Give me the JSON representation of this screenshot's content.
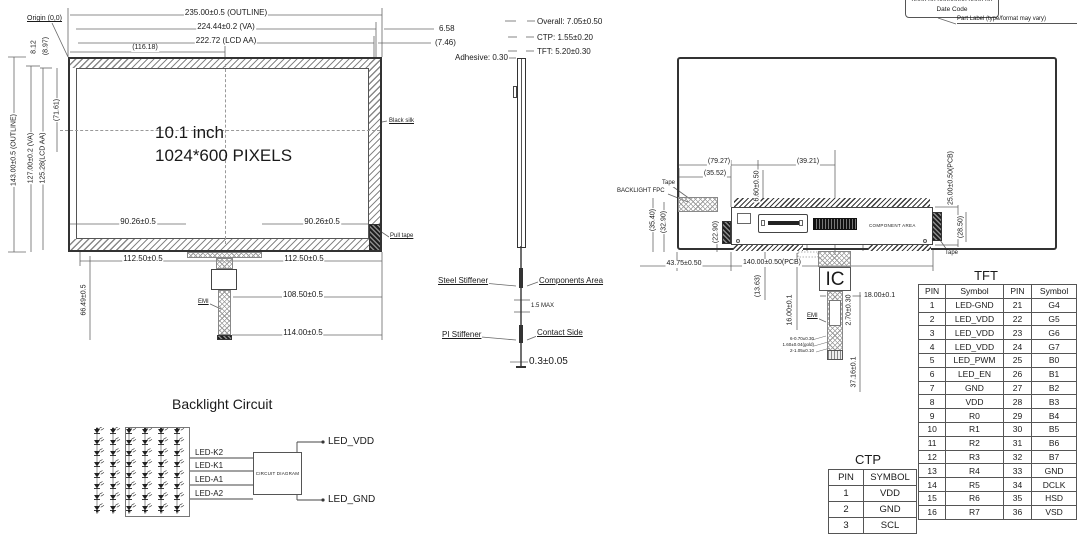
{
  "front_view": {
    "center_line1": "10.1 inch",
    "center_line2": "1024*600 PIXELS",
    "origin_label": "Origin (0,0)",
    "dim_outline_w": "235.00±0.5 (OUTLINE)",
    "dim_va_w": "224.44±0.2 (VA)",
    "dim_aa_w": "222.72 (LCD AA)",
    "dim_center_x": "(116.18)",
    "dim_right_gap": "6.58",
    "dim_right_gap2": "(7.46)",
    "dim_outline_h": "143.00±0.5 (OUTLINE)",
    "dim_va_h": "127.00±0.2 (VA)",
    "dim_aa_h": "125.28(LCD AA)",
    "dim_center_y": "(71.61)",
    "dim_top_gap": "8.12",
    "dim_top_gap2": "(8.97)",
    "black_silk_label": "Black silk",
    "pull_tape_label": "Pull tape",
    "dim_screw_left": "90.26±0.5",
    "dim_screw_right": "90.26±0.5",
    "dim_bottom_left": "112.50±0.5",
    "dim_bottom_right": "112.50±0.5",
    "dim_fpc_108": "108.50±0.5",
    "dim_fpc_114": "114.00±0.5",
    "dim_tail_v": "66.49±0.5",
    "emi_label": "EMI"
  },
  "side_view": {
    "overall": "Overall: 7.05±0.50",
    "ctp": "CTP: 1.55±0.20",
    "tft": "TFT: 5.20±0.30",
    "adhesive": "Adhesive: 0.30",
    "steel_stiffener": "Steel Stiffener",
    "components_area": "Components Area",
    "max_label": "1.5 MAX",
    "pi_stiffener": "PI Stiffener",
    "contact_side": "Contact Side",
    "bottom_dim": "0.3±0.05"
  },
  "back_view": {
    "part_no_clipped": "XXXX-XX-XXXXXXXX-XXXX-XX",
    "date_code": "Date Code",
    "part_label_note": "Part Label (type/format may vary)",
    "tape_left": "Tape",
    "backlight_fpc": "BACKLIGHT FPC",
    "component_area": "COMPONENT AREA",
    "tape_right": "Tape",
    "ic_label": "IC",
    "emi_label": "EMI",
    "dims": {
      "d7927": "(79.27)",
      "d3552": "(35.52)",
      "d3921": "(39.21)",
      "d660": "6.60±0.50",
      "d25pcb": "25.00±0.50(PCB)",
      "d3540": "(35.40)",
      "d3290": "(32.90)",
      "d2290": "(22.90)",
      "d2850": "(28.50)",
      "d4375": "43.75±0.50",
      "d140pcb": "140.00±0.50(PCB)",
      "d1363": "(13.63)",
      "d16": "16.00±0.1",
      "d18": "18.00±0.1",
      "d270": "2.70±0.30",
      "d3716": "37.16±0.1",
      "fpc_note1": "6-0.70±0.30",
      "fpc_note2": "1.60±0.04(gold)",
      "fpc_note3": "2-1.05±0.10"
    }
  },
  "backlight_circuit": {
    "title": "Backlight Circuit",
    "wire_labels": [
      "LED-K2",
      "LED-K1",
      "LED-A1",
      "LED-A2"
    ],
    "box_label": "CIRCUIT DIAGRAM",
    "out_top": "LED_VDD",
    "out_bottom": "LED_GND"
  },
  "ctp_table": {
    "title": "CTP",
    "headers": [
      "PIN",
      "SYMBOL"
    ],
    "rows": [
      [
        "1",
        "VDD"
      ],
      [
        "2",
        "GND"
      ],
      [
        "3",
        "SCL"
      ]
    ]
  },
  "tft_table": {
    "title": "TFT",
    "headers": [
      "PIN",
      "Symbol",
      "PIN",
      "Symbol"
    ],
    "rows": [
      [
        "1",
        "LED-GND",
        "21",
        "G4"
      ],
      [
        "2",
        "LED_VDD",
        "22",
        "G5"
      ],
      [
        "3",
        "LED_VDD",
        "23",
        "G6"
      ],
      [
        "4",
        "LED_VDD",
        "24",
        "G7"
      ],
      [
        "5",
        "LED_PWM",
        "25",
        "B0"
      ],
      [
        "6",
        "LED_EN",
        "26",
        "B1"
      ],
      [
        "7",
        "GND",
        "27",
        "B2"
      ],
      [
        "8",
        "VDD",
        "28",
        "B3"
      ],
      [
        "9",
        "R0",
        "29",
        "B4"
      ],
      [
        "10",
        "R1",
        "30",
        "B5"
      ],
      [
        "11",
        "R2",
        "31",
        "B6"
      ],
      [
        "12",
        "R3",
        "32",
        "B7"
      ],
      [
        "13",
        "R4",
        "33",
        "GND"
      ],
      [
        "14",
        "R5",
        "34",
        "DCLK"
      ],
      [
        "15",
        "R6",
        "35",
        "HSD"
      ],
      [
        "16",
        "R7",
        "36",
        "VSD"
      ]
    ]
  },
  "colors": {
    "line": "#555555",
    "ink": "#1a1a1a",
    "paper": "#ffffff"
  }
}
